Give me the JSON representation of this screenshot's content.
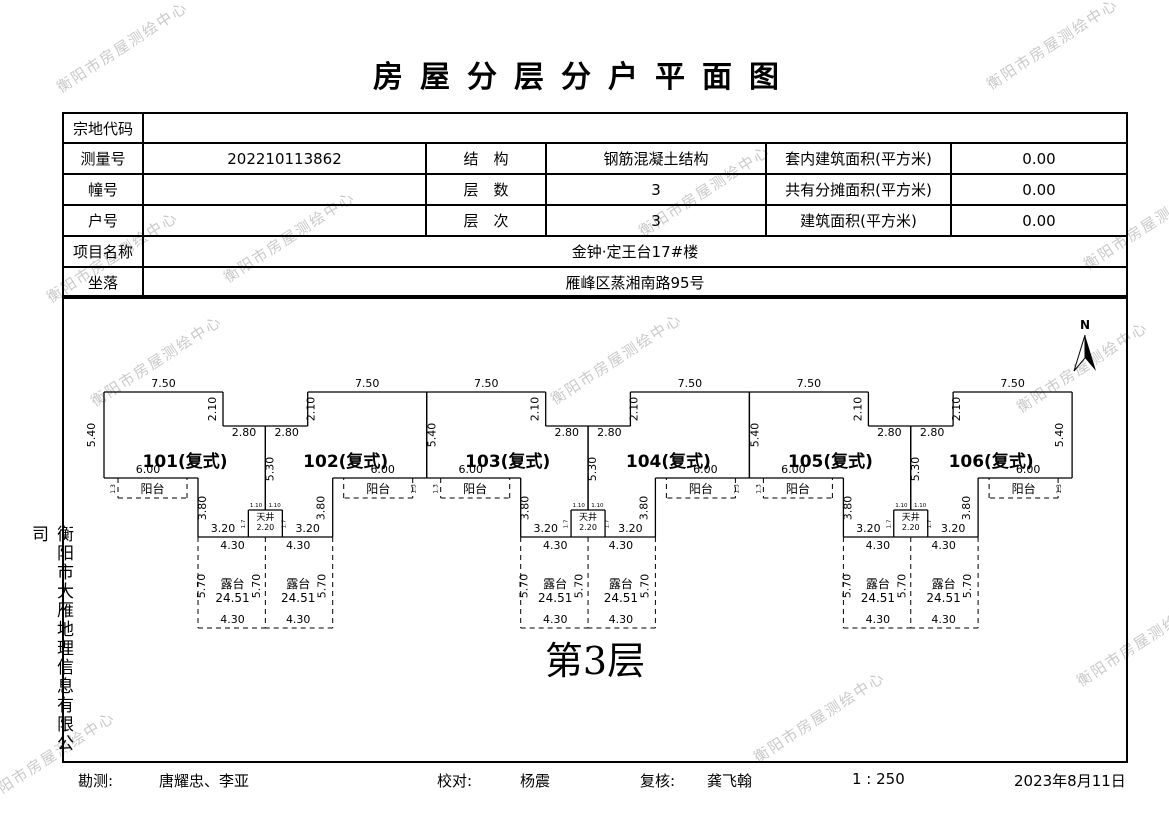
{
  "title": "房屋分层分户平面图",
  "watermark": {
    "text": "衡阳市房屋测绘中心"
  },
  "side_company": "衡阳市大雁地理信息有限公司",
  "info_table": {
    "parcel_label": "宗地代码",
    "parcel_value": "",
    "survey_label": "测量号",
    "survey_value": "202210113862",
    "structure_label": "结　构",
    "structure_value": "钢筋混凝土结构",
    "inner_area_label": "套内建筑面积(平方米)",
    "inner_area_value": "0.00",
    "building_label": "幢号",
    "building_value": "",
    "floors_label": "层　数",
    "floors_value": "3",
    "shared_area_label": "共有分摊面积(平方米)",
    "shared_area_value": "0.00",
    "unit_label": "户号",
    "unit_value": "",
    "level_label": "层　次",
    "level_value": "3",
    "floor_area_label": "建筑面积(平方米)",
    "floor_area_value": "0.00",
    "project_label": "项目名称",
    "project_value": "金钟·定王台17#楼",
    "location_label": "坐落",
    "location_value": "雁峰区蒸湘南路95号"
  },
  "plan": {
    "floor_label": "第3层",
    "north_label": "N",
    "units": [
      "101(复式)",
      "102(复式)",
      "103(复式)",
      "104(复式)",
      "105(复式)",
      "106(复式)"
    ],
    "dims": {
      "top": "7.50",
      "notch_v": "2.10",
      "notch_h": "2.80",
      "side": "5.40",
      "mid": "5.30",
      "body_bottom": "6.00",
      "balcony": "阳台",
      "balcony_side": "1.3",
      "step_v": "3.80",
      "step_h": "3.20",
      "well": "天井",
      "well_w": "2.20",
      "well_half": "1.10",
      "well_side": "1.7",
      "terrace_top": "4.30",
      "terrace_side": "5.70",
      "terrace": "露台",
      "terrace_area": "24.51",
      "terrace_bottom": "4.30"
    }
  },
  "footer": {
    "survey_label": "勘测:",
    "survey_value": "唐耀忠、李亚",
    "check_label": "校对:",
    "check_value": "杨震",
    "review_label": "复核:",
    "review_value": "龚飞翰",
    "scale": "1 : 250",
    "date": "2023年8月11日"
  }
}
